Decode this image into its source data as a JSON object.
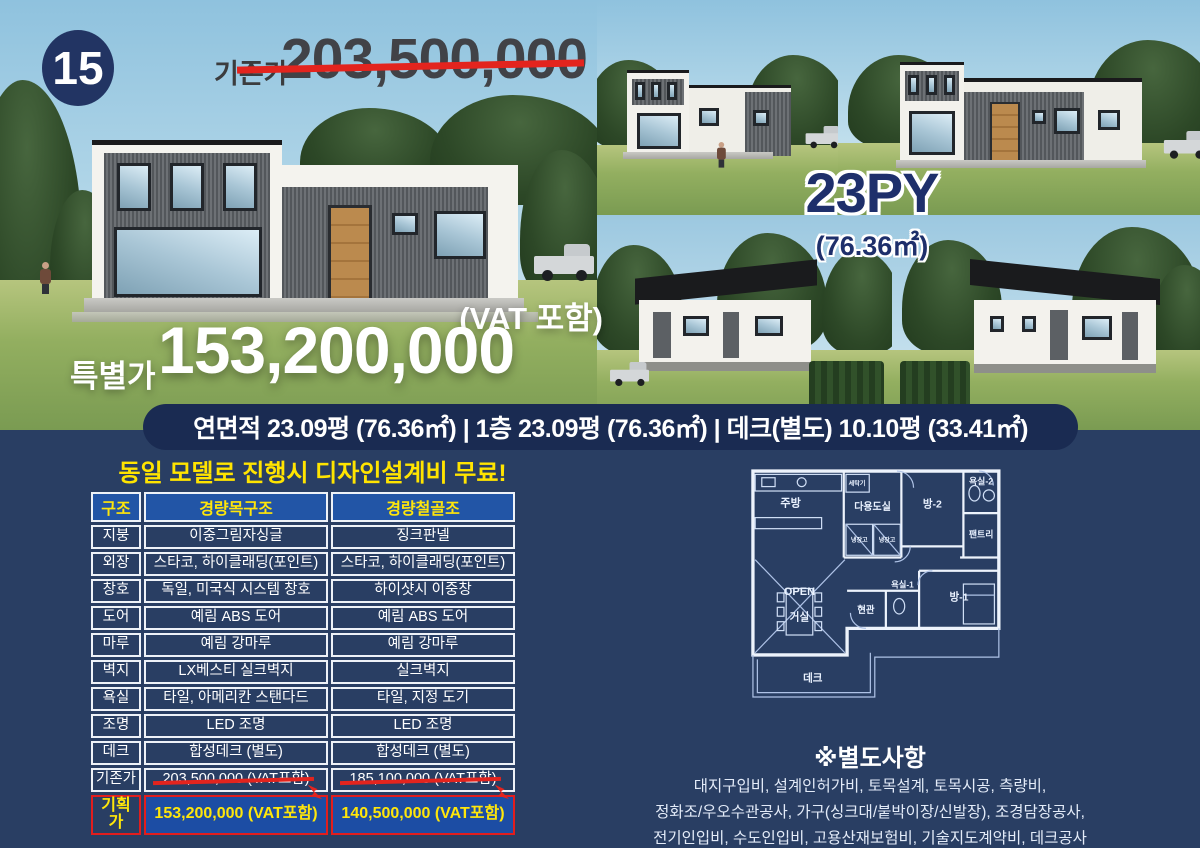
{
  "badge": {
    "number": "15"
  },
  "original_price": {
    "label": "기존가",
    "value": "203,500,000"
  },
  "special_price": {
    "vat_note": "(VAT 포함)",
    "label": "특별가",
    "value": "153,200,000"
  },
  "model": {
    "size_label": "23PY",
    "area_label": "(76.36㎡)"
  },
  "area_banner": {
    "text": "연면적 23.09평 (76.36㎡) | 1층 23.09평 (76.36㎡) | 데크(별도) 10.10평 (33.41㎡)"
  },
  "promo": {
    "text": "동일 모델로 진행시 디자인설계비 무료!"
  },
  "spec_table": {
    "headers": [
      "구조",
      "경량목구조",
      "경량철골조"
    ],
    "rows": [
      [
        "지붕",
        "이중그림자싱글",
        "징크판넬"
      ],
      [
        "외장",
        "스타코, 하이클래딩(포인트)",
        "스타코, 하이클래딩(포인트)"
      ],
      [
        "창호",
        "독일, 미국식 시스템 창호",
        "하이샷시 이중창"
      ],
      [
        "도어",
        "예림 ABS 도어",
        "예림 ABS 도어"
      ],
      [
        "마루",
        "예림 강마루",
        "예림 강마루"
      ],
      [
        "벽지",
        "LX베스티 실크벽지",
        "실크벽지"
      ],
      [
        "욕실",
        "타일, 아메리칸 스탠다드",
        "타일, 지정 도기"
      ],
      [
        "조명",
        "LED 조명",
        "LED 조명"
      ],
      [
        "데크",
        "합성데크 (별도)",
        "합성데크 (별도)"
      ]
    ],
    "old_price_row": {
      "label": "기존가",
      "values": [
        "203,500,000 (VAT포함)",
        "185,100,000 (VAT포함)"
      ]
    },
    "plan_price_row": {
      "label": "기획가",
      "values": [
        "153,200,000 (VAT포함)",
        "140,500,000 (VAT포함)"
      ]
    }
  },
  "floor_plan": {
    "kitchen": "주방",
    "washer": "세탁기",
    "utility": "다용도실",
    "fridge": "냉장고",
    "room2": "방-2",
    "bath2": "욕실-2",
    "pantry": "팬트리",
    "open": "OPEN",
    "living": "거실",
    "entry": "현관",
    "bath1": "욕실-1",
    "room1": "방-1",
    "deck": "데크"
  },
  "extras": {
    "heading": "※별도사항",
    "lines": [
      "대지구입비, 설계인허가비, 토목설계, 토목시공, 측량비,",
      "정화조/우오수관공사, 가구(싱크대/붙박이장/신발장), 조경담장공사,",
      "전기인입비, 수도인입비, 고용산재보험비, 기술지도계약비, 데크공사"
    ]
  },
  "colors": {
    "page_navy": "#293e63",
    "pill_navy": "#1a2b52",
    "header_blue": "#2255a6",
    "plan_price_blue": "#1c4da4",
    "accent_yellow": "#ffe400",
    "accent_red": "#e3241e",
    "price_navy_text": "#1e2f6b"
  }
}
